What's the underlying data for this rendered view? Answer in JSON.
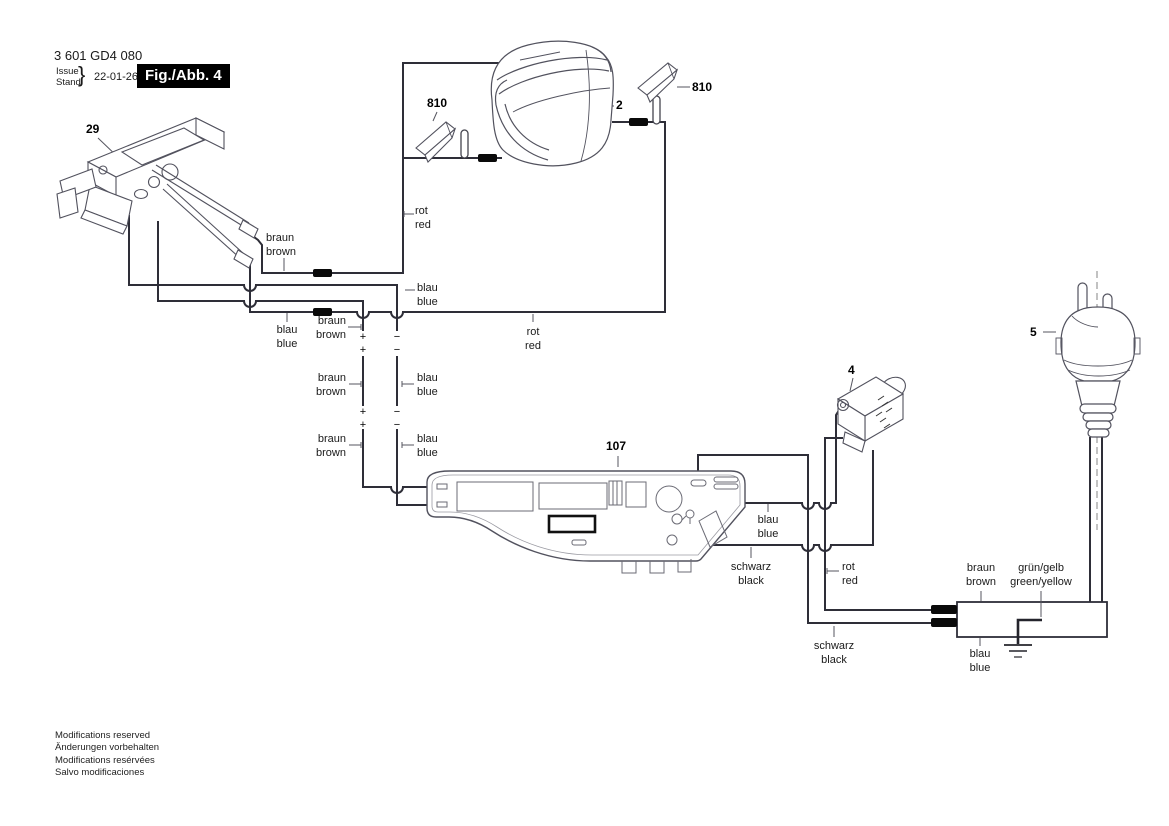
{
  "header": {
    "part_number": "3 601 GD4 080",
    "issue_label": "Issue",
    "stand_label": "Stand",
    "brace": "}",
    "date": "22-01-26",
    "figure_label": "Fig./Abb. 4"
  },
  "parts": {
    "switch": "29",
    "field": "2",
    "brush_left": "810",
    "brush_right": "810",
    "suppressor": "4",
    "plug": "5",
    "electronic_module": "107"
  },
  "wire_labels": [
    {
      "de": "rot",
      "en": "red"
    },
    {
      "de": "braun",
      "en": "brown"
    },
    {
      "de": "blau",
      "en": "blue"
    },
    {
      "de": "blau",
      "en": "blue"
    },
    {
      "de": "braun",
      "en": "brown"
    },
    {
      "de": "rot",
      "en": "red"
    },
    {
      "de": "braun",
      "en": "brown"
    },
    {
      "de": "blau",
      "en": "blue"
    },
    {
      "de": "braun",
      "en": "brown"
    },
    {
      "de": "blau",
      "en": "blue"
    },
    {
      "de": "blau",
      "en": "blue"
    },
    {
      "de": "schwarz",
      "en": "black"
    },
    {
      "de": "rot",
      "en": "red"
    },
    {
      "de": "braun",
      "en": "brown"
    },
    {
      "de": "grün/gelb",
      "en": "green/yellow"
    },
    {
      "de": "schwarz",
      "en": "black"
    },
    {
      "de": "blau",
      "en": "blue"
    }
  ],
  "polarity_marks": [
    "+",
    "+",
    "+",
    "+",
    "−",
    "−",
    "−",
    "−"
  ],
  "footer": {
    "lines": [
      "Modifications reserved",
      "Änderungen vorbehalten",
      "Modifications resérvées",
      "Salvo modificaciones"
    ]
  },
  "colors": {
    "wire": "#2e2e38",
    "connector": "#0a0a0a",
    "drawing": "#52525e",
    "label": "#1a1a1a",
    "leader": "#55555f",
    "figure_box_bg": "#000000",
    "figure_box_text": "#ffffff"
  }
}
